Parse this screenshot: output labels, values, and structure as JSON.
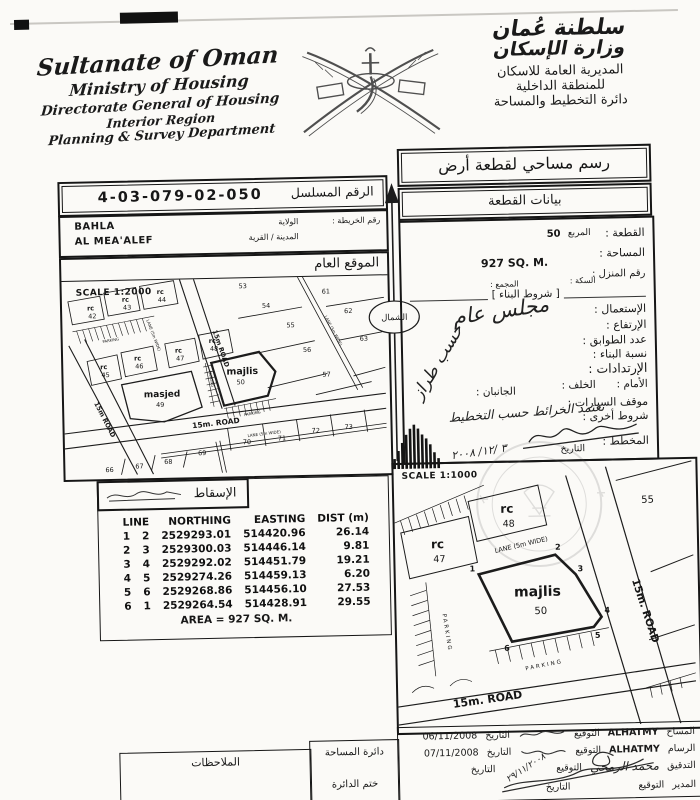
{
  "icons": {
    "emblem": "oman-national-emblem",
    "north_arrow": "north-arrow",
    "signature": "signature-scribble"
  },
  "header": {
    "en_lines": [
      "Sultanate of Oman",
      "Ministry of Housing",
      "Directorate General of Housing",
      "Interior Region",
      "Planning & Survey Department"
    ],
    "ar_callig_1": "سلطنة عُمان",
    "ar_callig_2": "وزارة الإسكان",
    "ar_lines": [
      "المديرية العامة للاسكان",
      "للمنطقة الداخلية",
      "دائرة التخطيط والمساحة"
    ]
  },
  "title_box": {
    "label": "رسم مساحي لقطعة أرض"
  },
  "data_box": {
    "label": "بيانات القطعة"
  },
  "serial": {
    "label": "الرقم المسلسل",
    "value": "4-03-079-02-050"
  },
  "location": {
    "map_no_label": "رقم الخريطة :",
    "wilaya_label": "الولاية",
    "wilaya_value": "BAHLA",
    "town_label": "المدينة / القرية",
    "town_value": "AL MEA'ALEF"
  },
  "plot": {
    "plot_label": "القطعة :",
    "plot_value": "50",
    "square_label": "المربع",
    "area_label": "المساحة :",
    "area_value": "927 SQ. M.",
    "house_label": "رقم المنزل :",
    "street_label": "السكة :",
    "complex_label": "المجمع :",
    "conditions_title": "[ شروط البناء ]",
    "use_label": "الإستعمال :",
    "use_hand": "مجلس عام",
    "height_label": "الإرتفاع :",
    "floors_label": "عدد الطوابق :",
    "ratio_label": "نسبة البناء :",
    "ratio_hand": "حسب طراز",
    "setbacks_label": "الإرتدادات :",
    "front_label": "الأمام :",
    "back_label": "الخلف :",
    "sides_label": "الجانبان :",
    "parking_label": "موقف السيارات :",
    "other_label": "شروط أخرى :",
    "other_hand": "تعتمد الخرائط حسب التخطيط",
    "planner_label": "المخطط :",
    "planner_date_label": "التاريخ",
    "planner_date_hand": "٣ /١٢/ ٢٠٠٨"
  },
  "site_plan": {
    "header": "الموقع العام",
    "scale": "SCALE 1:2000",
    "labels": {
      "rc": "rc",
      "masjed": "masjed",
      "n49": "49",
      "majlis": "majlis",
      "n50": "50",
      "n42": "42",
      "n43": "43",
      "n44": "44",
      "n45": "45",
      "n46": "46",
      "n47": "47",
      "n48": "48",
      "n53": "53",
      "n54": "54",
      "n55": "55",
      "n56": "56",
      "n57": "57",
      "n61": "61",
      "n62": "62",
      "n63": "63",
      "n66": "66",
      "n67": "67",
      "n68": "68",
      "n69": "69",
      "n70": "70",
      "n71": "71",
      "n72": "72",
      "n73": "73",
      "road_15m": "15m ROAD",
      "road_15m_dot": "15m. ROAD",
      "lane": "LANE (5m WIDE)",
      "parking": "PARKING"
    }
  },
  "north": {
    "label": "الشمال"
  },
  "projection": {
    "header": "الإسقاط",
    "col_line": "LINE",
    "col_northing": "NORTHING",
    "col_easting": "EASTING",
    "col_dist": "DIST (m)",
    "rows": [
      {
        "from": "1",
        "to": "2",
        "northing": "2529293.01",
        "easting": "514420.96",
        "dist": "26.14"
      },
      {
        "from": "2",
        "to": "3",
        "northing": "2529300.03",
        "easting": "514446.14",
        "dist": "9.81"
      },
      {
        "from": "3",
        "to": "4",
        "northing": "2529292.02",
        "easting": "514451.79",
        "dist": "19.21"
      },
      {
        "from": "4",
        "to": "5",
        "northing": "2529274.26",
        "easting": "514459.13",
        "dist": "6.20"
      },
      {
        "from": "5",
        "to": "6",
        "northing": "2529268.86",
        "easting": "514456.10",
        "dist": "27.53"
      },
      {
        "from": "6",
        "to": "1",
        "northing": "2529264.54",
        "easting": "514428.91",
        "dist": "29.55"
      }
    ],
    "area_note": "AREA = 927 SQ. M."
  },
  "detail_plan": {
    "scale": "SCALE 1:1000",
    "labels": {
      "rc": "rc",
      "n47": "47",
      "n48": "48",
      "n55": "55",
      "majlis": "majlis",
      "n50": "50",
      "lane": "LANE (5m WIDE)",
      "road_diag": "15m. ROAD",
      "road_bottom": "15m. ROAD",
      "parking": "PARKING",
      "c1": "1",
      "c2": "2",
      "c3": "3",
      "c4": "4",
      "c5": "5",
      "c6": "6"
    }
  },
  "footer": {
    "notes": "الملاحظات",
    "dept": "دائرة المساحة",
    "stamp": "ختم الدائرة",
    "rows": [
      {
        "role": "المساح",
        "name": "ALHATMY",
        "sig": "التوقيع",
        "date_label": "التاريخ",
        "date": "06/11/2008"
      },
      {
        "role": "الرسام",
        "name": "ALHATMY",
        "sig": "التوقيع",
        "date_label": "التاريخ",
        "date": "07/11/2008"
      },
      {
        "role": "التدقيق",
        "name": "محمد الرمحي",
        "sig": "التوقيع",
        "date_label": "التاريخ",
        "date": "٢٩/١١/٢٠٠٨"
      },
      {
        "role": "المدير",
        "name": "",
        "sig": "التوقيع",
        "date_label": "التاريخ",
        "date": ""
      }
    ]
  }
}
